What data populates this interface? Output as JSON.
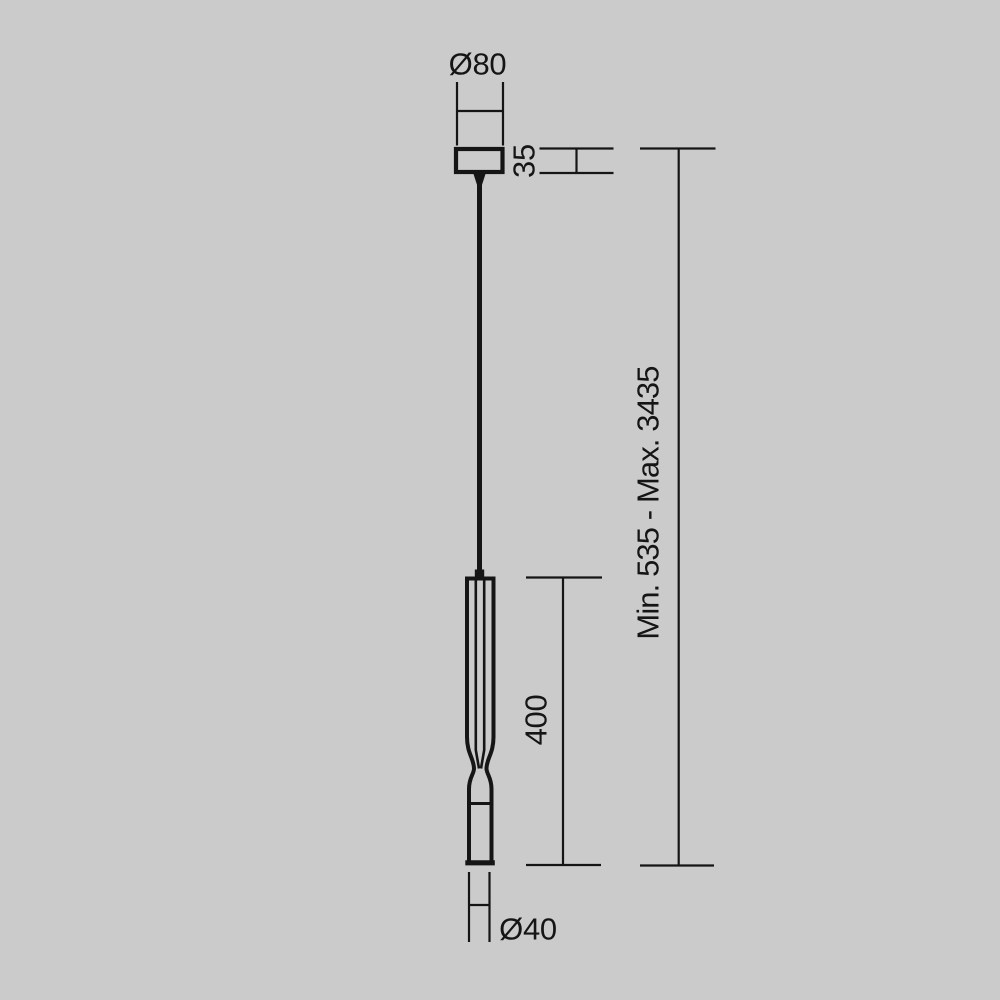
{
  "theme": {
    "background": "#cbcbcb",
    "ink": "#151515"
  },
  "drawing": {
    "type": "technical-dimension-drawing",
    "subject": "pendant-lamp-side-view",
    "dimensions": [
      {
        "id": "canopy-diameter",
        "label": "Ø80",
        "value": 80,
        "orientation": "horizontal"
      },
      {
        "id": "canopy-height",
        "label": "35",
        "value": 35,
        "orientation": "vertical"
      },
      {
        "id": "suspension-total-height",
        "label": "Min. 535 - Max. 3435",
        "min": 535,
        "max": 3435,
        "orientation": "vertical"
      },
      {
        "id": "lamp-body-height",
        "label": "400",
        "value": 400,
        "orientation": "vertical"
      },
      {
        "id": "lamp-body-diameter",
        "label": "Ø40",
        "value": 40,
        "orientation": "horizontal"
      }
    ]
  }
}
